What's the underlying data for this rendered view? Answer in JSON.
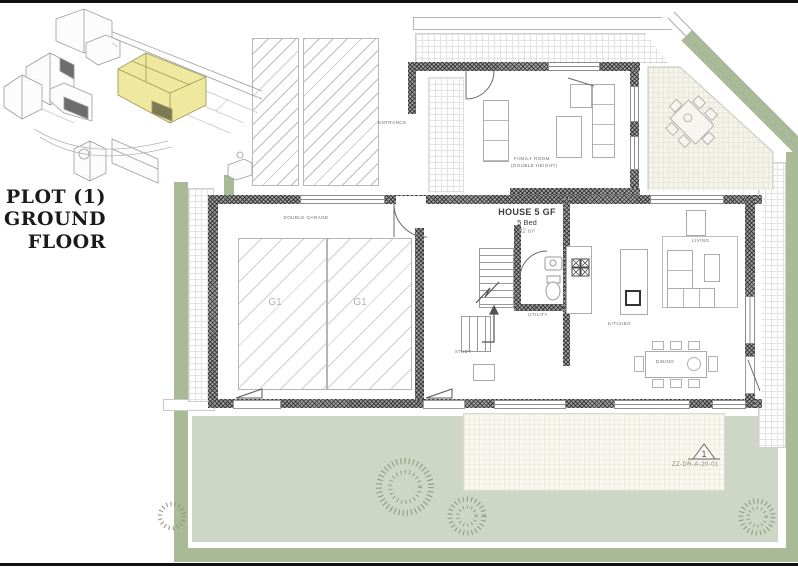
{
  "title_block": {
    "lines": [
      "PLOT (1)",
      "GROUND",
      "FLOOR"
    ]
  },
  "plan": {
    "house_name": "HOUSE 5 GF",
    "beds": "5 Bed",
    "area": "92 m²",
    "labels": {
      "entrance": "ENTRANCE",
      "family_room": "FAMILY ROOM",
      "family_room_note": "(DOUBLE HEIGHT)",
      "double_garage": "DOUBLE GARAGE",
      "garage_bays": [
        "G1",
        "G1"
      ],
      "living": "LIVING",
      "kitchen": "KITCHEN",
      "dining": "DINING",
      "utility": "UTILITY",
      "study": "STUDY"
    }
  },
  "annotations": {
    "revision_number": "1",
    "drawing_reference": "ZZ-DR-A-20-01"
  },
  "icons": {
    "hob-burner": "✕",
    "stair-direction": "↑",
    "revision-marker": "△"
  },
  "colors": {
    "highlight-yellow": "#efe9a0",
    "garden-light": "#ced7c5",
    "garden-dark": "#a8bb96",
    "wall-dark": "#5f5f5f",
    "line-gray": "#9a9a9a"
  }
}
